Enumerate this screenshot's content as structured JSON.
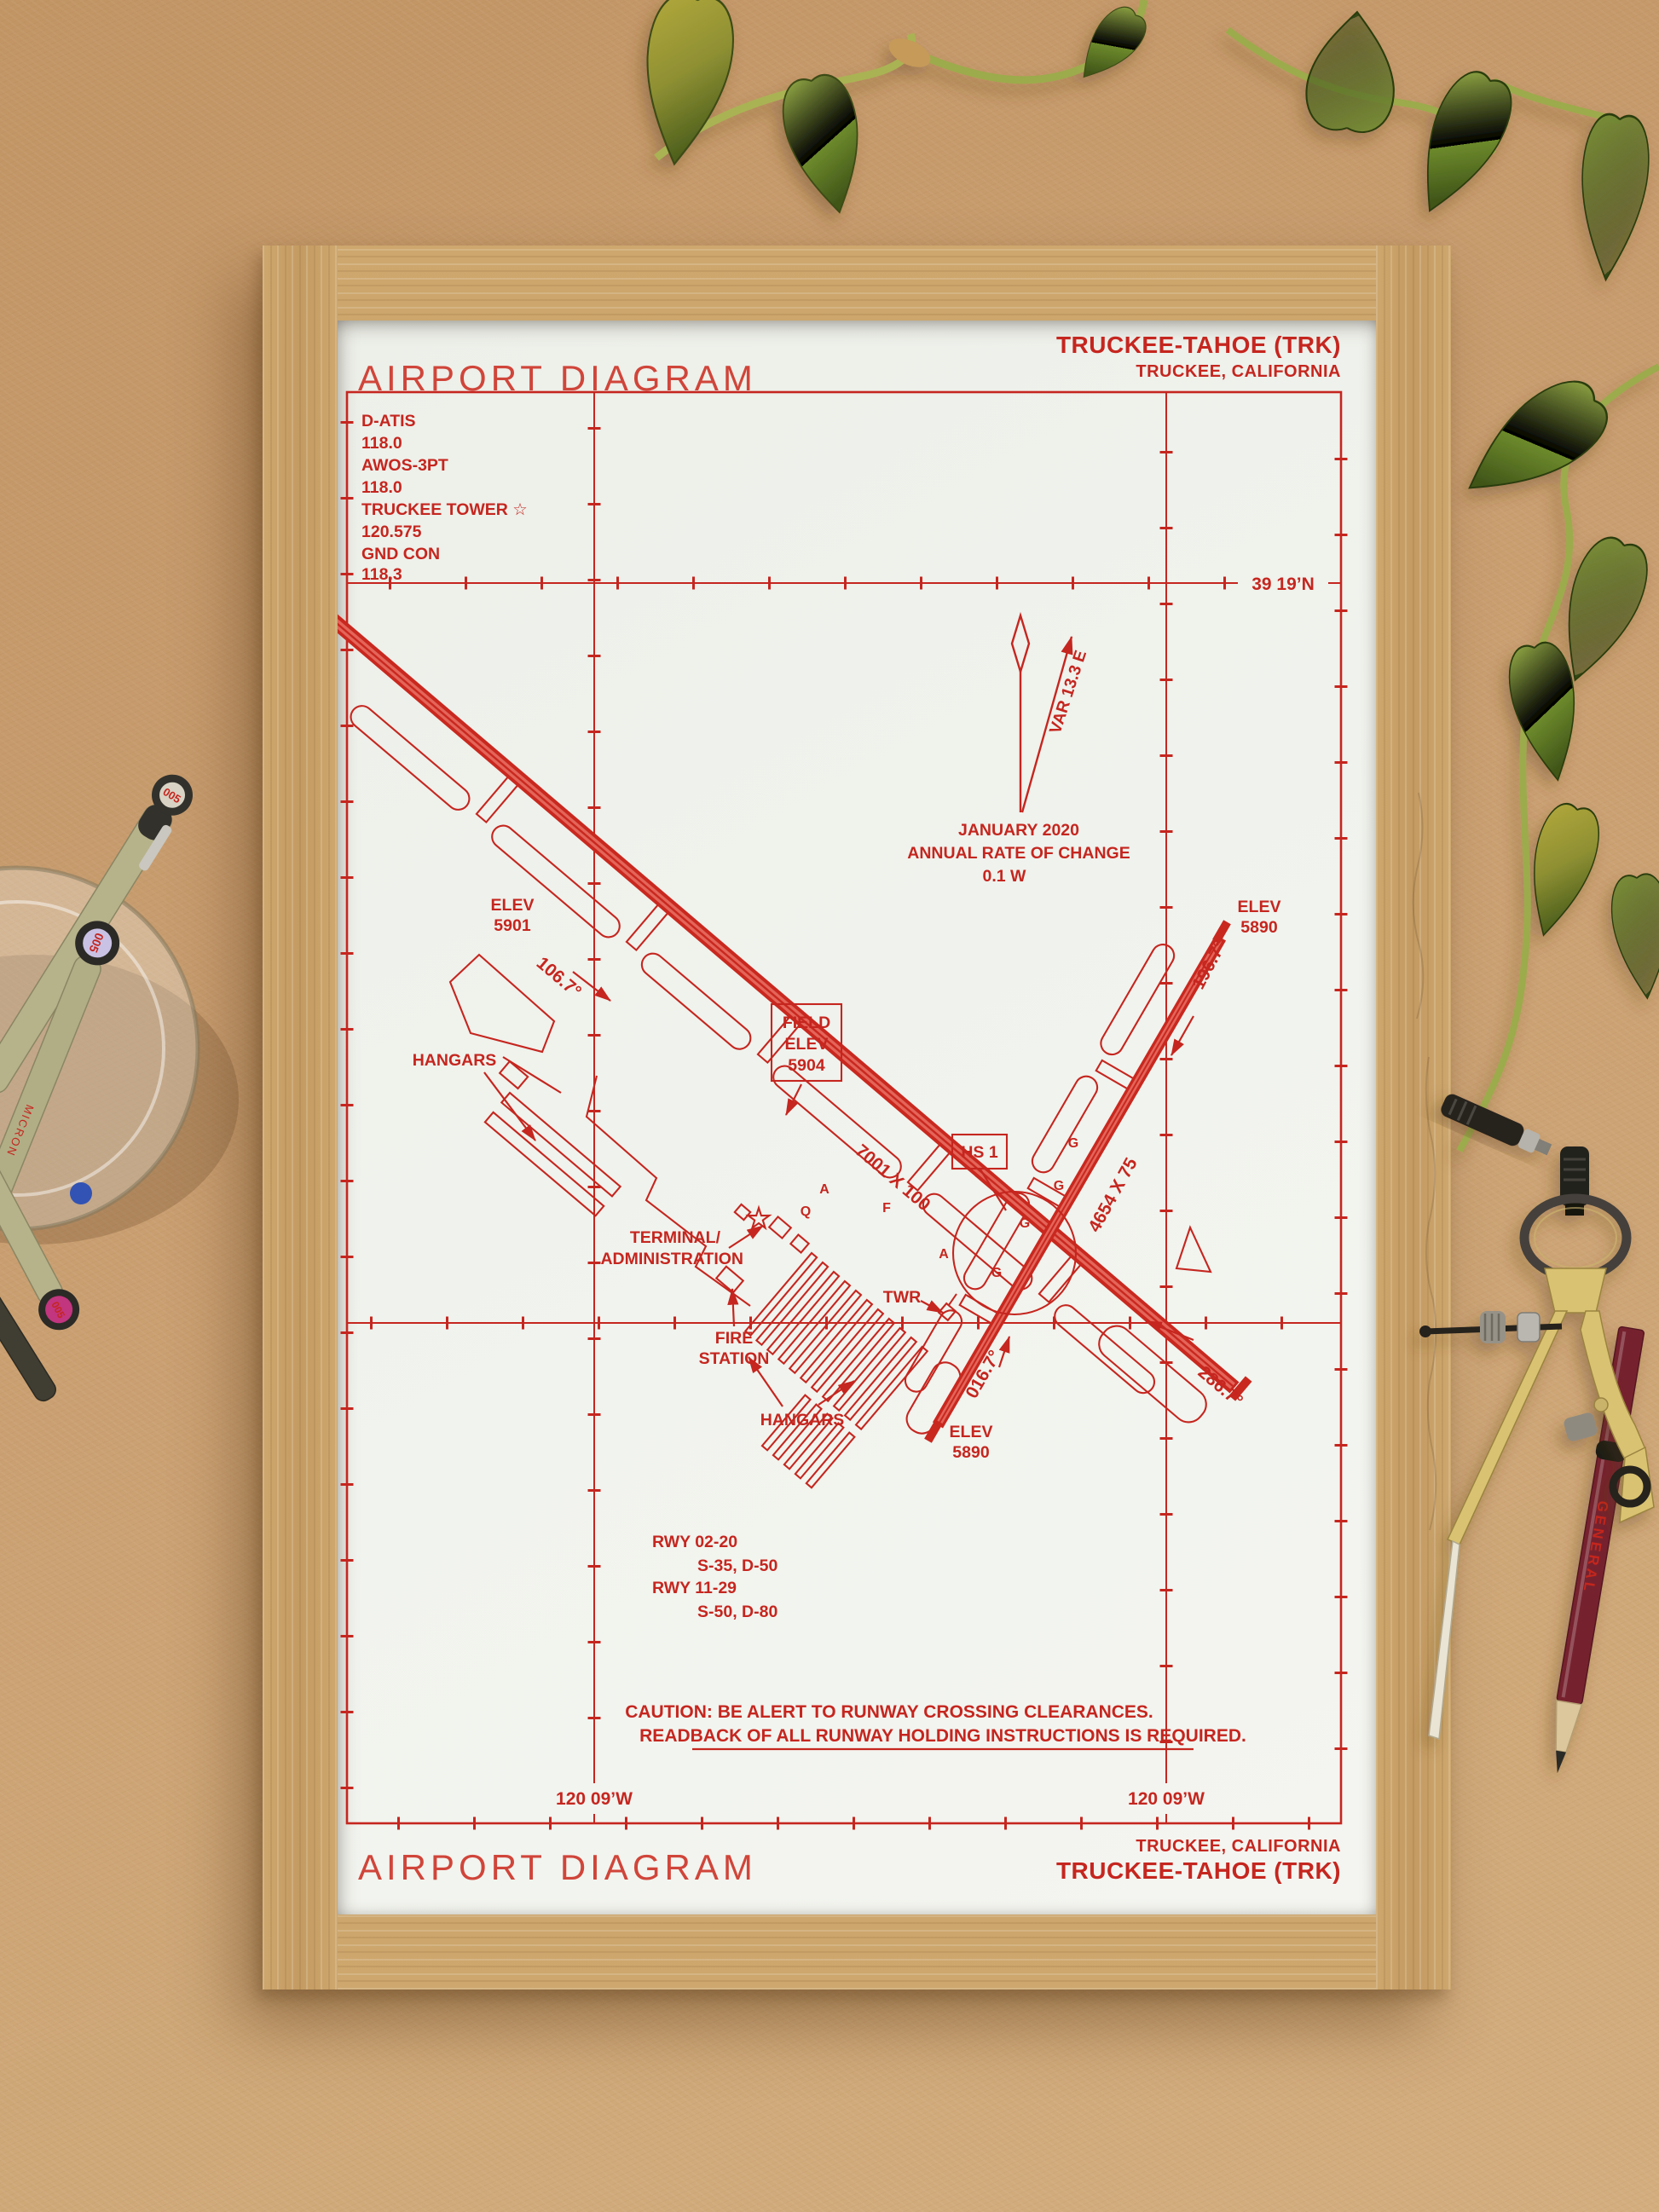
{
  "colors": {
    "ink": "#c5261f",
    "paper": "#f1f3ee",
    "wood": "#c9a369",
    "cardboard": "#c89d6f",
    "leaf_green": "#7b9138",
    "brass": "#d9c271",
    "pencil_body": "#76222e"
  },
  "poster": {
    "top": {
      "title": "AIRPORT DIAGRAM",
      "airport": "TRUCKEE-TAHOE (TRK)",
      "city": "TRUCKEE, CALIFORNIA"
    },
    "freqs": [
      "D-ATIS",
      "118.0",
      "AWOS-3PT",
      "118.0",
      "TRUCKEE TOWER ☆",
      "120.575",
      "GND CON",
      "118.3"
    ],
    "coords": {
      "lat": "39 19’N",
      "lon_left": "120 09’W",
      "lon_right": "120 09’W"
    },
    "magnetic": {
      "var": "VAR 13.3 E",
      "line1": "JANUARY 2020",
      "line2": "ANNUAL RATE OF CHANGE",
      "line3": "0.1  W"
    },
    "field_elev": {
      "l1": "FIELD",
      "l2": "ELEV",
      "l3": "5904"
    },
    "hot_spot": "HS 1",
    "runways": {
      "rwy1129_size": "7001 X 100",
      "rwy0220_size": "4654 X 75",
      "hdg11": "106.7°",
      "hdg29": "286.7°",
      "hdg02": "016.7°",
      "hdg20": "196.7°",
      "elev11_l1": "ELEV",
      "elev11_l2": "5901",
      "elev20_l1": "ELEV",
      "elev20_l2": "5890",
      "elev02_l1": "ELEV",
      "elev02_l2": "5890"
    },
    "labels": {
      "hangars_nw": "HANGARS",
      "hangars_s": "HANGARS",
      "terminal_l1": "TERMINAL/",
      "terminal_l2": "ADMINISTRATION",
      "tower": "TWR",
      "fire_l1": "FIRE",
      "fire_l2": "STATION"
    },
    "taxiway_letters": [
      "A",
      "Q",
      "F",
      "A",
      "G",
      "G",
      "G",
      "G"
    ],
    "runway_data": [
      "RWY 02-20",
      "S-35, D-50",
      "RWY 11-29",
      "S-50, D-80"
    ],
    "caution": {
      "line1": "CAUTION: BE ALERT TO RUNWAY CROSSING CLEARANCES.",
      "line2": "READBACK OF ALL RUNWAY HOLDING INSTRUCTIONS IS REQUIRED."
    },
    "bottom": {
      "title": "AIRPORT DIAGRAM",
      "city": "TRUCKEE, CALIFORNIA",
      "airport": "TRUCKEE-TAHOE (TRK)"
    }
  },
  "props": {
    "pen_brand": "MICRON",
    "pen_size": "005",
    "pencil_brand": "GENERAL"
  }
}
